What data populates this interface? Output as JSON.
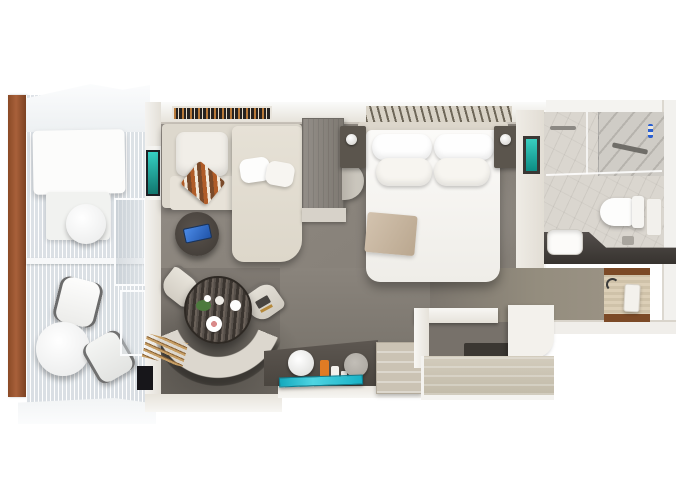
{
  "meta": {
    "title": "Suite stateroom floor plan — top-down 3D render",
    "description": "Top-down 3D rendered floor plan of a cruise suite: balcony with lounger, chairs and tables; living area with sectional sofa, TV and round dining table with curved banquette; bedroom with queen bed, nightstands and vanity desk; marble bathroom with shower, toilet and stone vanity; entry hall and wardrobe."
  },
  "palette": {
    "background": "#ffffff",
    "carpet": "#8b857c",
    "carpet_dark": "#6b665f",
    "wall_cream": "#e7e3db",
    "wall_white": "#f7f6f3",
    "wood_rail": "#9d5a33",
    "entry_wood": "#d6c8ae",
    "accent_teal": "#1fb7c8",
    "tv_teal": "#2ec4b6",
    "tablet_blue": "#2f6fd0",
    "bottle_orange": "#e07b24",
    "marble_light": "#d8d4cd",
    "counter_dark": "#413c39",
    "throw_beige": "#c9b8a4",
    "sofa_cream": "#e6e1d6",
    "table_wood_dark": "#4d453e"
  },
  "rooms": [
    {
      "id": "balcony",
      "label": "Balcony"
    },
    {
      "id": "living-area",
      "label": "Living Area"
    },
    {
      "id": "bedroom",
      "label": "Bedroom"
    },
    {
      "id": "bathroom",
      "label": "Bathroom"
    },
    {
      "id": "entry",
      "label": "Entry"
    },
    {
      "id": "wardrobe",
      "label": "Wardrobe"
    }
  ],
  "furniture": {
    "balcony": [
      "Daybed lounger",
      "Round side table",
      "Cafe table",
      "Two chairs",
      "Glass sliding door"
    ],
    "living_area": [
      "Sectional sofa with chaise",
      "Striped throw blanket",
      "Round side table with tablet",
      "Wall-mounted TV",
      "Bookshelf",
      "Round dining table",
      "Curved banquette bench",
      "Two dining chairs",
      "Media cabinet",
      "Half-round table"
    ],
    "bedroom": [
      "Queen bed with four pillows",
      "Beige throw",
      "Two nightstands with lamps",
      "Vanity desk with lamp and toiletries",
      "Teal runner",
      "Drawer dresser",
      "Teal wall art",
      "Slatted headboard wall"
    ],
    "bathroom": [
      "Walk-in shower",
      "Toilet",
      "Dark stone vanity with sink",
      "Towel bar",
      "Wall unit"
    ],
    "entry": [
      "Entry door",
      "Wood threshold floor"
    ],
    "wardrobe": [
      "Open closet shelf",
      "Storage cabinet"
    ]
  }
}
